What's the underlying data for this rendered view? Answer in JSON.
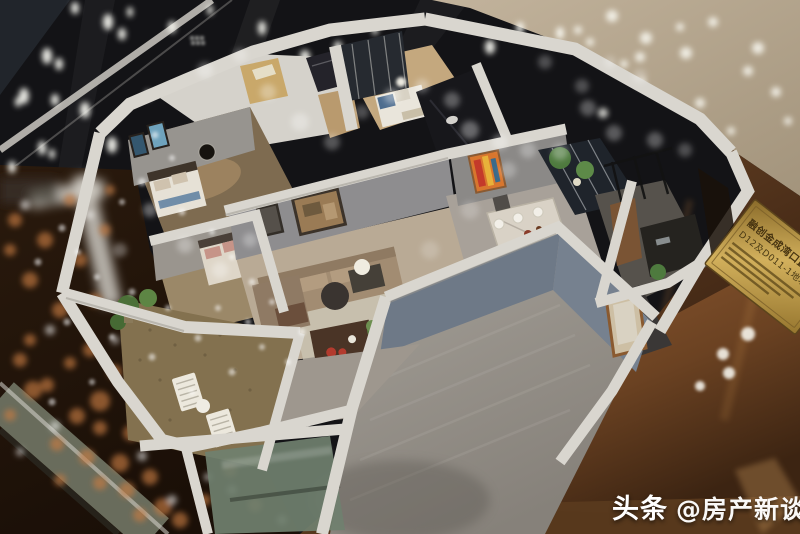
{
  "watermark": {
    "brand": "头条",
    "handle": "@房产新谈"
  },
  "plaque": {
    "line1": "融创金成湾口置业",
    "line2": "D12及D011-1地块"
  },
  "palette": {
    "background_dark": "#131316",
    "glass_copper": "#7a4e28",
    "plaque_gold": "#c9a84e",
    "wall_white": "#d9d6cf",
    "wood_deck": "#83714f",
    "interior_blue_wall": "#6e7987",
    "bokeh_orange": "#c77c42",
    "bokeh_white": "#ffffff"
  }
}
